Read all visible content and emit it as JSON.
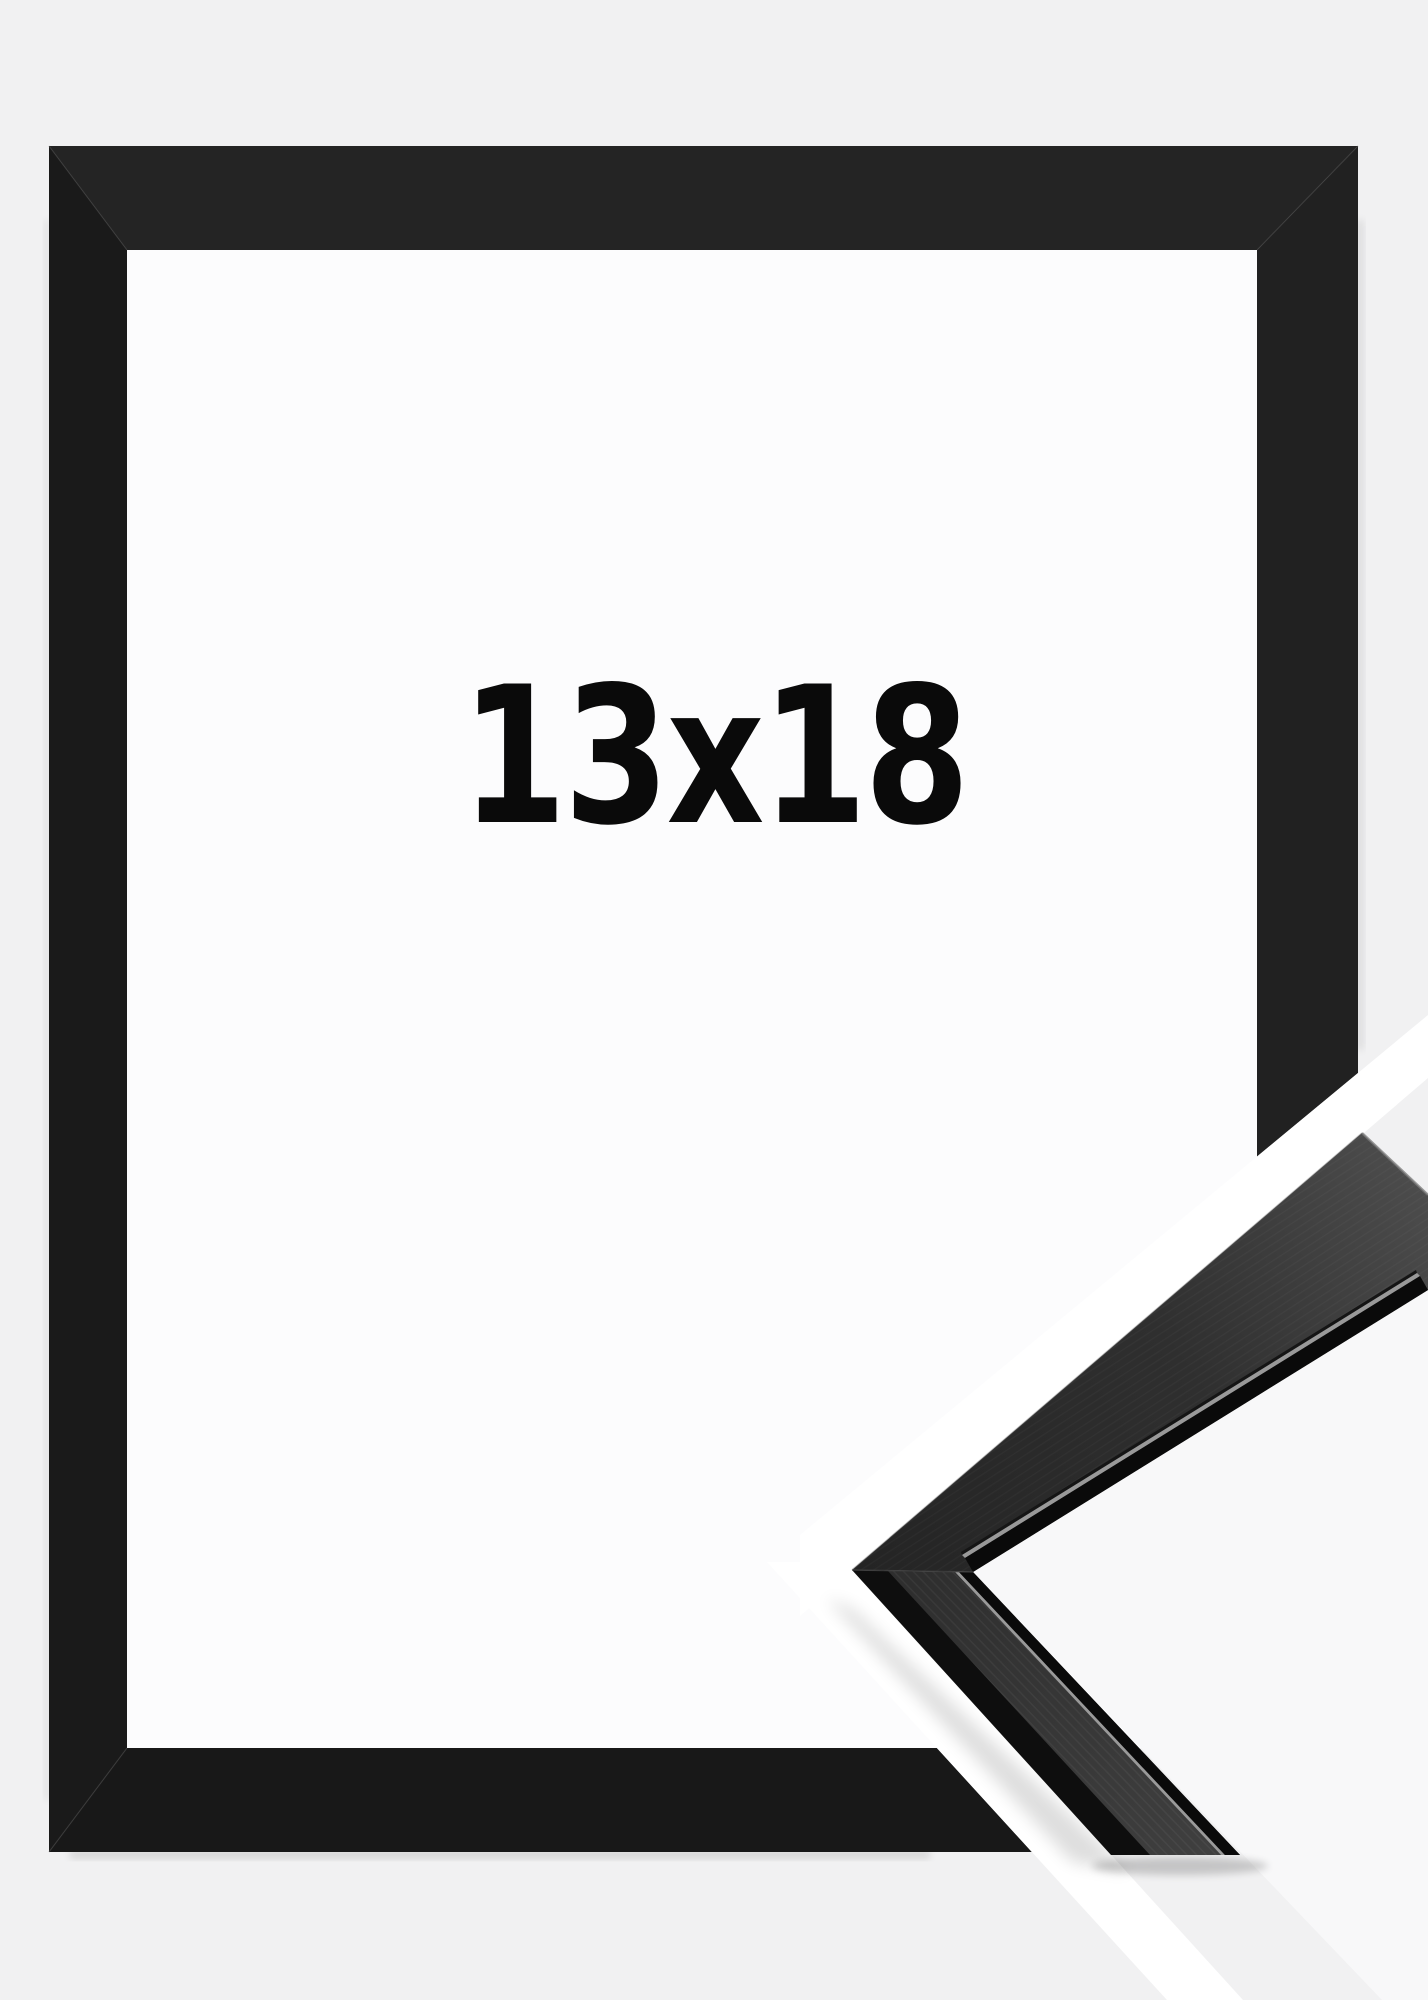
{
  "product": {
    "size_label": "13x18",
    "frame_color_name": "black",
    "description": "empty black picture frame, straight-on view, with detached corner profile sample at lower right"
  },
  "colors": {
    "background": "#f1f1f2",
    "opening": "#fcfcfd",
    "cut_gap": "#ffffff",
    "between_arms": "#f8f8f9",
    "frame_top": "#242424",
    "frame_left": "#1a1a1a",
    "frame_right": "#212121",
    "frame_bottom": "#181818",
    "sample_outer_face": "#0e0e0e",
    "sample_lip": "#0a0a0a",
    "sample_highlight": "#999999",
    "label_color": "#0a0a0a"
  }
}
